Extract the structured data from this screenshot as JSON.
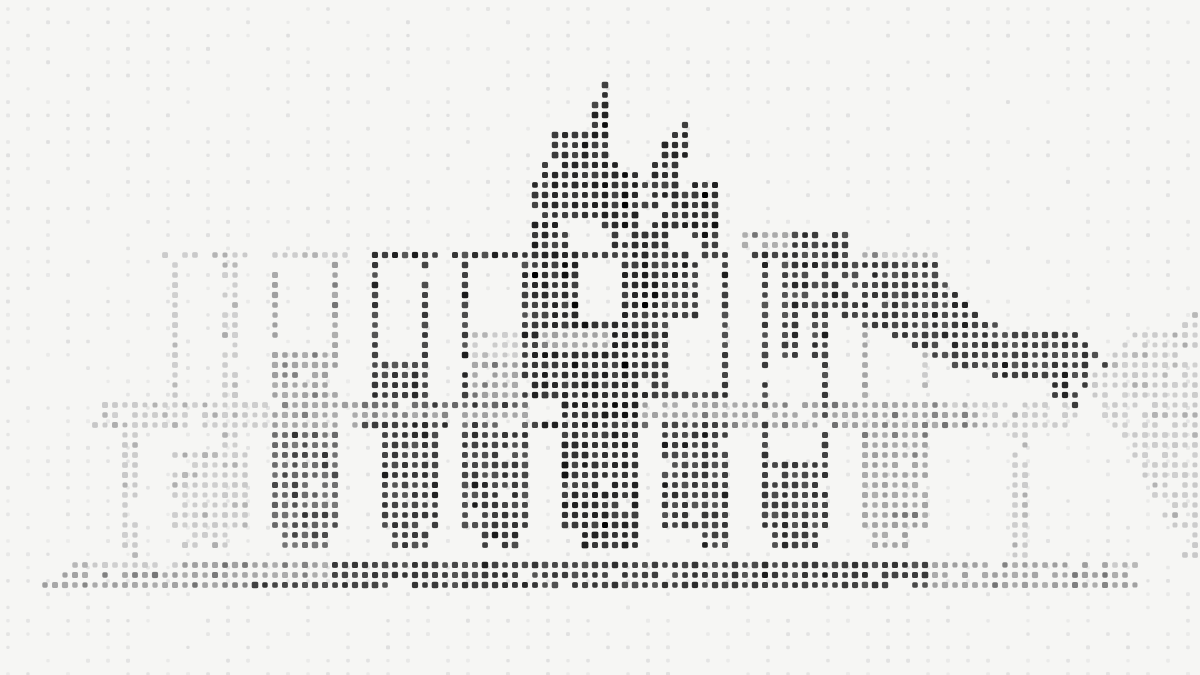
{
  "alt": "Dot-matrix halftone artwork of an industrial building skyline: outlined rectangular towers on the left, a dark spiky central structure with two pointed turrets, a long dark diagonal sloping roof descending to the right, a parallel light-gray diagonal band at the far right, a horizontal dotted band across the middle, colonnade-like filled pillars below it, and a dotted baseline, all over a faint background dot grid",
  "canvas": {
    "width": 1200,
    "height": 675,
    "background": "#f6f6f4"
  },
  "palette": {
    "darkest": "#1f1f1f",
    "dark": "#333333",
    "mid_dark": "#5f5f5f",
    "medium": "#9d9d9d",
    "light": "#c7c7c7",
    "background_dot": "#dfdfdf"
  },
  "art_grid": {
    "pitch": 10,
    "dot_size": 6.4,
    "corner_radius": 1.8,
    "cols": 120,
    "rows": 68
  },
  "background_grid": {
    "offset_x": 8,
    "offset_y": 9,
    "pitch_x": 20,
    "pitch_y": 13.3,
    "dot_size": 4,
    "corner_radius": 1.2,
    "visibility": 0.6
  },
  "shade_styles": {
    "DD": {
      "color": "#1f1f1f",
      "size": 6.8,
      "skip": 0.02,
      "speckle_to": "#000000",
      "speckle_p": 0.1
    },
    "D": {
      "color": "#333333",
      "size": 6.6,
      "skip": 0.04,
      "speckle_to": "#1a1a1a",
      "speckle_p": 0.15
    },
    "MD": {
      "color": "#5f5f5f",
      "size": 6.4,
      "skip": 0.05,
      "speckle_to": "#333333",
      "speckle_p": 0.2
    },
    "M": {
      "color": "#9d9d9d",
      "size": 6.2,
      "skip": 0.07,
      "speckle_to": "#6f6f6f",
      "speckle_p": 0.15
    },
    "L": {
      "color": "#c7c7c7",
      "size": 6.0,
      "skip": 0.1,
      "speckle_to": "#ababab",
      "speckle_p": 0.18
    }
  },
  "shapes": [
    [
      "row",
      40,
      10,
      26,
      "L"
    ],
    [
      "row",
      40,
      27,
      35,
      "M"
    ],
    [
      "row",
      40,
      36,
      52,
      "MD"
    ],
    [
      "row",
      40,
      56,
      63,
      "DD"
    ],
    [
      "row",
      40,
      64,
      74,
      "M"
    ],
    [
      "row",
      40,
      75,
      85,
      "M"
    ],
    [
      "row",
      40,
      86,
      93,
      "M"
    ],
    [
      "row",
      40,
      94,
      107,
      "L"
    ],
    [
      "row",
      41,
      10,
      26,
      "L"
    ],
    [
      "row",
      41,
      27,
      35,
      "M"
    ],
    [
      "row",
      41,
      36,
      52,
      "M"
    ],
    [
      "row",
      41,
      56,
      63,
      "DD"
    ],
    [
      "row",
      41,
      64,
      85,
      "M"
    ],
    [
      "row",
      41,
      86,
      97,
      "M"
    ],
    [
      "row",
      41,
      98,
      107,
      "L"
    ],
    [
      "row",
      42,
      9,
      26,
      "L"
    ],
    [
      "row",
      42,
      27,
      35,
      "M"
    ],
    [
      "row",
      42,
      36,
      44,
      "D"
    ],
    [
      "row",
      42,
      45,
      52,
      "MD"
    ],
    [
      "row",
      42,
      53,
      63,
      "DD"
    ],
    [
      "row",
      42,
      64,
      65,
      "MD"
    ],
    [
      "row",
      42,
      66,
      72,
      "D"
    ],
    [
      "row",
      42,
      73,
      85,
      "M"
    ],
    [
      "row",
      42,
      86,
      97,
      "M"
    ],
    [
      "row",
      42,
      98,
      107,
      "L"
    ],
    [
      "row",
      56,
      7,
      17,
      "L"
    ],
    [
      "row",
      56,
      18,
      32,
      "M"
    ],
    [
      "row",
      56,
      33,
      92,
      "D"
    ],
    [
      "row",
      56,
      93,
      110,
      "M"
    ],
    [
      "row",
      56,
      111,
      113,
      "L"
    ],
    [
      "row",
      57,
      6,
      32,
      "M"
    ],
    [
      "row",
      57,
      33,
      92,
      "D"
    ],
    [
      "row",
      57,
      93,
      112,
      "M"
    ],
    [
      "row",
      58,
      4,
      24,
      "M"
    ],
    [
      "row",
      58,
      25,
      92,
      "D"
    ],
    [
      "row",
      58,
      93,
      113,
      "M"
    ],
    [
      "row",
      31,
      119,
      119,
      "L"
    ],
    [
      "row",
      32,
      118,
      119,
      "L"
    ],
    [
      "row",
      33,
      113,
      119,
      "L"
    ],
    [
      "row",
      34,
      112,
      119,
      "L"
    ],
    [
      "row",
      35,
      111,
      119,
      "L"
    ],
    [
      "row",
      36,
      111,
      119,
      "L"
    ],
    [
      "row",
      37,
      109,
      119,
      "L"
    ],
    [
      "row",
      38,
      109,
      119,
      "L"
    ],
    [
      "row",
      39,
      109,
      119,
      "L"
    ],
    [
      "row",
      40,
      110,
      119,
      "L"
    ],
    [
      "row",
      41,
      110,
      119,
      "L"
    ],
    [
      "row",
      42,
      111,
      119,
      "L"
    ],
    [
      "row",
      43,
      112,
      119,
      "L"
    ],
    [
      "row",
      44,
      112,
      119,
      "L"
    ],
    [
      "row",
      45,
      113,
      119,
      "L"
    ],
    [
      "row",
      46,
      114,
      119,
      "L"
    ],
    [
      "row",
      47,
      114,
      119,
      "L"
    ],
    [
      "row",
      48,
      115,
      119,
      "L"
    ],
    [
      "row",
      49,
      115,
      119,
      "L"
    ],
    [
      "row",
      50,
      116,
      119,
      "L"
    ],
    [
      "row",
      51,
      116,
      119,
      "L"
    ],
    [
      "row",
      52,
      117,
      119,
      "L"
    ],
    [
      "row",
      53,
      117,
      119,
      "L"
    ],
    [
      "row",
      54,
      118,
      119,
      "L"
    ],
    [
      "row",
      55,
      118,
      119,
      "L"
    ],
    [
      "row",
      25,
      16,
      24,
      "L"
    ],
    [
      "row",
      25,
      26,
      34,
      "L"
    ],
    [
      "row",
      25,
      36,
      43,
      "D"
    ],
    [
      "row",
      25,
      45,
      52,
      "D"
    ],
    [
      "col",
      17,
      26,
      39,
      "L"
    ],
    [
      "col",
      22,
      26,
      44,
      "L"
    ],
    [
      "col",
      23,
      26,
      44,
      "L"
    ],
    [
      "col",
      27,
      26,
      34,
      "M"
    ],
    [
      "col",
      33,
      26,
      34,
      "M"
    ],
    [
      "fill",
      27,
      35,
      33,
      39,
      "M"
    ],
    [
      "col",
      37,
      26,
      35,
      "D"
    ],
    [
      "col",
      42,
      26,
      35,
      "D"
    ],
    [
      "fill",
      37,
      36,
      42,
      39,
      "D"
    ],
    [
      "col",
      46,
      26,
      39,
      "D"
    ],
    [
      "col",
      52,
      26,
      39,
      "D"
    ],
    [
      "fill",
      47,
      33,
      51,
      35,
      "L"
    ],
    [
      "fill",
      47,
      36,
      51,
      39,
      "M"
    ],
    [
      "row",
      23,
      74,
      78,
      "M"
    ],
    [
      "row",
      23,
      79,
      84,
      "D"
    ],
    [
      "row",
      24,
      74,
      78,
      "M"
    ],
    [
      "row",
      24,
      79,
      84,
      "D"
    ],
    [
      "row",
      25,
      75,
      84,
      "D"
    ],
    [
      "row",
      25,
      86,
      87,
      "M"
    ],
    [
      "row",
      25,
      88,
      93,
      "L"
    ],
    [
      "fill",
      78,
      26,
      84,
      30,
      "D"
    ],
    [
      "col",
      76,
      26,
      45,
      "D"
    ],
    [
      "col",
      82,
      26,
      45,
      "D"
    ],
    [
      "col",
      78,
      31,
      35,
      "D"
    ],
    [
      "col",
      79,
      31,
      35,
      "D"
    ],
    [
      "col",
      81,
      31,
      35,
      "D"
    ],
    [
      "col",
      86,
      30,
      42,
      "M"
    ],
    [
      "col",
      92,
      30,
      38,
      "L"
    ],
    [
      "row",
      8,
      60,
      60,
      "DD"
    ],
    [
      "row",
      9,
      60,
      60,
      "DD"
    ],
    [
      "row",
      10,
      59,
      60,
      "DD"
    ],
    [
      "row",
      11,
      59,
      60,
      "DD"
    ],
    [
      "row",
      12,
      59,
      60,
      "DD"
    ],
    [
      "row",
      12,
      68,
      68,
      "DD"
    ],
    [
      "row",
      13,
      55,
      60,
      "DD"
    ],
    [
      "row",
      13,
      67,
      68,
      "DD"
    ],
    [
      "row",
      14,
      55,
      60,
      "DD"
    ],
    [
      "row",
      14,
      66,
      68,
      "DD"
    ],
    [
      "row",
      15,
      55,
      60,
      "DD"
    ],
    [
      "row",
      15,
      65,
      68,
      "DD"
    ],
    [
      "row",
      16,
      54,
      61,
      "DD"
    ],
    [
      "row",
      16,
      65,
      67,
      "DD"
    ],
    [
      "row",
      17,
      54,
      63,
      "DD"
    ],
    [
      "row",
      17,
      65,
      67,
      "DD"
    ],
    [
      "row",
      18,
      53,
      67,
      "DD"
    ],
    [
      "row",
      18,
      69,
      71,
      "DD"
    ],
    [
      "row",
      19,
      53,
      63,
      "DD"
    ],
    [
      "row",
      19,
      65,
      71,
      "DD"
    ],
    [
      "row",
      20,
      53,
      71,
      "DD"
    ],
    [
      "row",
      21,
      54,
      63,
      "DD"
    ],
    [
      "row",
      21,
      66,
      71,
      "DD"
    ],
    [
      "row",
      22,
      53,
      56,
      "DD"
    ],
    [
      "row",
      22,
      60,
      63,
      "DD"
    ],
    [
      "row",
      22,
      65,
      71,
      "DD"
    ],
    [
      "row",
      23,
      53,
      56,
      "DD"
    ],
    [
      "row",
      23,
      61,
      66,
      "DD"
    ],
    [
      "row",
      23,
      69,
      71,
      "DD"
    ],
    [
      "row",
      24,
      53,
      56,
      "DD"
    ],
    [
      "row",
      24,
      61,
      66,
      "DD"
    ],
    [
      "row",
      24,
      70,
      71,
      "DD"
    ],
    [
      "row",
      25,
      53,
      72,
      "DD"
    ],
    [
      "fill",
      53,
      26,
      56,
      39,
      "DD"
    ],
    [
      "col",
      57,
      26,
      32,
      "DD"
    ],
    [
      "fill",
      62,
      26,
      65,
      32,
      "DD"
    ],
    [
      "fill",
      66,
      26,
      69,
      31,
      "D"
    ],
    [
      "row",
      32,
      56,
      66,
      "DD"
    ],
    [
      "fill",
      54,
      33,
      60,
      34,
      "M"
    ],
    [
      "fill",
      61,
      33,
      65,
      34,
      "DD"
    ],
    [
      "fill",
      53,
      35,
      65,
      39,
      "DD"
    ],
    [
      "col",
      66,
      32,
      39,
      "D"
    ],
    [
      "col",
      72,
      26,
      39,
      "D"
    ],
    [
      "row",
      39,
      66,
      72,
      "D"
    ],
    [
      "row",
      26,
      85,
      93,
      "D"
    ],
    [
      "row",
      27,
      85,
      93,
      "D"
    ],
    [
      "row",
      28,
      85,
      94,
      "D"
    ],
    [
      "row",
      29,
      86,
      95,
      "D"
    ],
    [
      "row",
      30,
      83,
      96,
      "D"
    ],
    [
      "row",
      31,
      84,
      97,
      "D"
    ],
    [
      "row",
      32,
      86,
      99,
      "D"
    ],
    [
      "row",
      33,
      89,
      107,
      "D"
    ],
    [
      "row",
      34,
      91,
      108,
      "D"
    ],
    [
      "row",
      35,
      93,
      109,
      "D"
    ],
    [
      "row",
      36,
      95,
      110,
      "D"
    ],
    [
      "row",
      37,
      99,
      108,
      "D"
    ],
    [
      "row",
      38,
      103,
      108,
      "D"
    ],
    [
      "row",
      39,
      105,
      107,
      "D"
    ],
    [
      "row",
      40,
      107,
      107,
      "D"
    ],
    [
      "fill",
      12,
      43,
      13,
      55,
      "L"
    ],
    [
      "fill",
      22,
      43,
      23,
      44,
      "L"
    ],
    [
      "fill",
      17,
      45,
      24,
      52,
      "L"
    ],
    [
      "fill",
      18,
      53,
      22,
      54,
      "L"
    ],
    [
      "fill",
      27,
      43,
      33,
      52,
      "MD"
    ],
    [
      "fill",
      28,
      53,
      32,
      54,
      "MD"
    ],
    [
      "fill",
      38,
      43,
      43,
      52,
      "D"
    ],
    [
      "fill",
      39,
      53,
      42,
      54,
      "D"
    ],
    [
      "fill",
      46,
      43,
      52,
      52,
      "D"
    ],
    [
      "fill",
      48,
      53,
      51,
      54,
      "D"
    ],
    [
      "fill",
      56,
      43,
      63,
      52,
      "DD"
    ],
    [
      "fill",
      58,
      53,
      63,
      54,
      "DD"
    ],
    [
      "fill",
      66,
      43,
      72,
      52,
      "D"
    ],
    [
      "fill",
      70,
      53,
      72,
      54,
      "D"
    ],
    [
      "fill",
      76,
      46,
      82,
      52,
      "D"
    ],
    [
      "fill",
      77,
      53,
      81,
      54,
      "D"
    ],
    [
      "fill",
      86,
      43,
      92,
      52,
      "M"
    ],
    [
      "fill",
      87,
      53,
      90,
      54,
      "M"
    ],
    [
      "fill",
      101,
      43,
      102,
      55,
      "L"
    ]
  ]
}
